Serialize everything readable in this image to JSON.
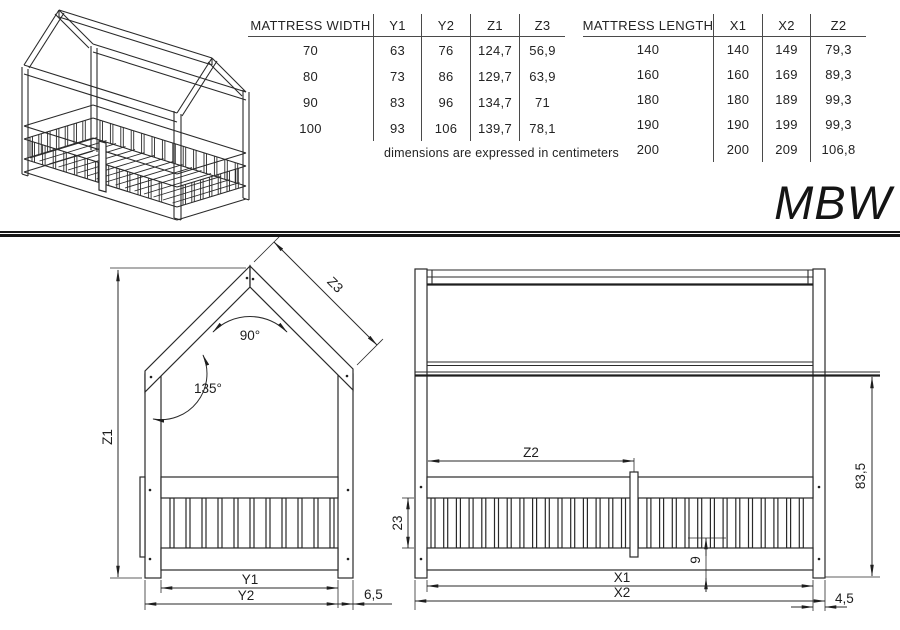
{
  "model": "MBW",
  "note": "dimensions are expressed in centimeters",
  "tables": [
    {
      "title": "MATTRESS WIDTH",
      "columns": [
        "Y1",
        "Y2",
        "Z1",
        "Z3"
      ],
      "rows": [
        [
          "70",
          "63",
          "76",
          "124,7",
          "56,9"
        ],
        [
          "80",
          "73",
          "86",
          "129,7",
          "63,9"
        ],
        [
          "90",
          "83",
          "96",
          "134,7",
          "71"
        ],
        [
          "100",
          "93",
          "106",
          "139,7",
          "78,1"
        ]
      ]
    },
    {
      "title": "MATTRESS LENGTH",
      "columns": [
        "X1",
        "X2",
        "Z2"
      ],
      "rows": [
        [
          "140",
          "140",
          "149",
          "79,3"
        ],
        [
          "160",
          "160",
          "169",
          "89,3"
        ],
        [
          "180",
          "180",
          "189",
          "99,3"
        ],
        [
          "190",
          "190",
          "199",
          "99,3"
        ],
        [
          "200",
          "200",
          "209",
          "106,8"
        ]
      ]
    }
  ],
  "front_view": {
    "labels": {
      "height": "Z1",
      "roof": "Z3",
      "apex_angle": "90°",
      "eave_angle": "135°",
      "inner_width": "Y1",
      "outer_width": "Y2",
      "post_width": "6,5"
    }
  },
  "side_view": {
    "labels": {
      "gate": "Z2",
      "slat_height": "23",
      "base": "9",
      "wall_height": "83,5",
      "inner_length": "X1",
      "outer_length": "X2",
      "post_width": "4,5"
    }
  },
  "colors": {
    "line": "#2a2a2a",
    "background": "#ffffff"
  }
}
